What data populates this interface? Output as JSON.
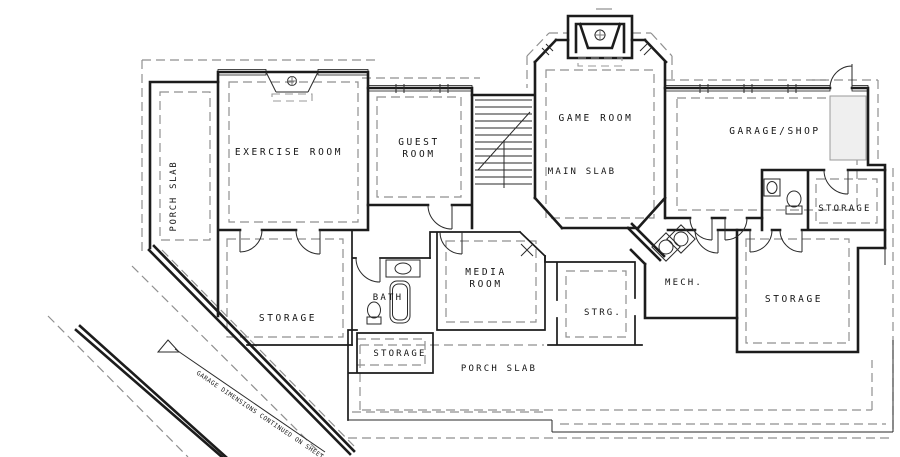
{
  "plan": {
    "rooms": {
      "porch_slab_left": "PORCH SLAB",
      "exercise_room": "EXERCISE ROOM",
      "guest_room_line1": "GUEST",
      "guest_room_line2": "ROOM",
      "game_room": "GAME ROOM",
      "main_slab": "MAIN SLAB",
      "garage_shop": "GARAGE/SHOP",
      "storage_upper_right": "STORAGE",
      "media_room_line1": "MEDIA",
      "media_room_line2": "ROOM",
      "bath": "BATH",
      "storage_left": "STORAGE",
      "storage_bottom_center": "STORAGE",
      "strg": "STRG.",
      "mech": "MECH.",
      "storage_lower_right": "STORAGE",
      "porch_slab_bottom": "PORCH SLAB"
    },
    "annotations": {
      "garage_note": "GARAGE DIMENSIONS CONTINUED ON SHEET"
    },
    "colors": {
      "wall": "#1c1c1c",
      "overhang_dashed": "#8f8f8f",
      "background": "#ffffff"
    }
  }
}
